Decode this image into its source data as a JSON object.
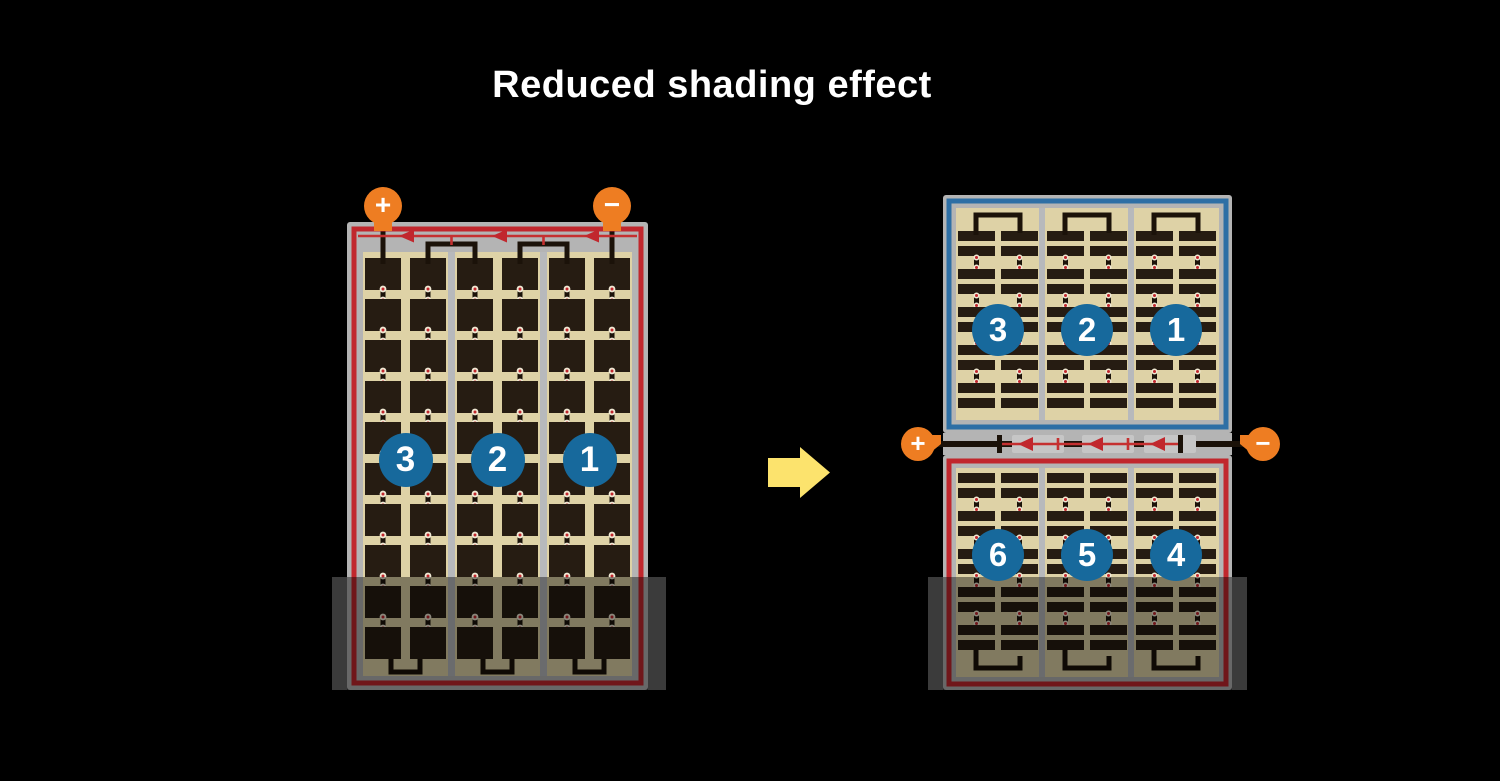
{
  "title": "Reduced shading effect",
  "left_module": {
    "description": "conventional full-cell module",
    "string_numbers": [
      "3",
      "2",
      "1"
    ],
    "terminals": {
      "positive": "+",
      "negative": "−"
    },
    "shaded": true
  },
  "right_modules": {
    "top": {
      "string_numbers": [
        "3",
        "2",
        "1"
      ],
      "shaded": false
    },
    "bottom": {
      "string_numbers": [
        "6",
        "5",
        "4"
      ],
      "shaded": true
    },
    "terminals": {
      "positive": "+",
      "negative": "−"
    }
  },
  "colors": {
    "background": "#000000",
    "title_text": "#ffffff",
    "panel_frame": "#b4b4b4",
    "divider": "#b7b9bc",
    "cell_background": "#ded2a6",
    "cell": "#261c12",
    "red_border": "#c1272d",
    "blue_border": "#2e6fa5",
    "diode_line": "#c53030",
    "diode_arrow": "#c1272d",
    "wire": "#1b1209",
    "sleeve": "#c6c6c6",
    "terminal_orange": "#ee7d22",
    "terminal_text": "#ffffff",
    "number_circle": "#17699c",
    "number_text": "#ffffff",
    "arrow_yellow": "#fce36d",
    "connector_ring": "#f0e9d4",
    "connector_dot": "#c1272d",
    "shade_band": "#3b3b3b",
    "shade_overlay": "rgba(0,0,0,0.42)"
  }
}
